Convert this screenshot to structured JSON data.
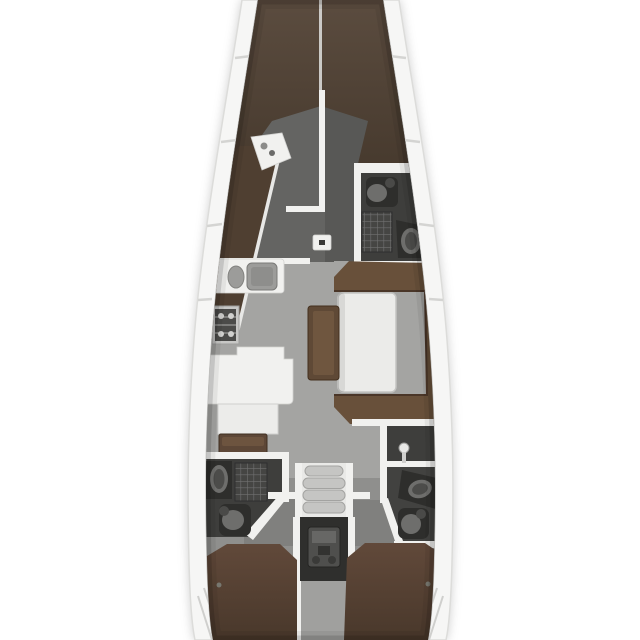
{
  "meta": {
    "title": "Sailing yacht interior floor plan",
    "view": "top-down, bow at top",
    "canvas": {
      "width": 640,
      "height": 640
    }
  },
  "colors": {
    "pageBg": "#ffffff",
    "hullBand": "#f6f6f5",
    "hullOutline": "#dcdcda",
    "deckLine": "#bdbdbb",
    "floorForward": "#646462",
    "floorForwardStbd": "#585856",
    "floorSalon": "#a4a4a2",
    "floorAft": "#8f8f8d",
    "floorCabinEntry": "#80807e",
    "floorCorridor": "#a0a09e",
    "headFloor": "#3e3e3c",
    "berth": "#54463a",
    "berthDark": "#4f3f31",
    "settee": "#68503a",
    "benchSeat": "#5f4936",
    "navSeat": "#5d4737",
    "aftBerth": "#5c4636",
    "white": "#f1f1ef",
    "fixtureLight": "#6e6e6c",
    "fixtureDark": "#2e2e2c",
    "stairTread": "#c5c5c3",
    "engineBay": "#2f2f2d",
    "engine": "#4f4f4d",
    "tableTop": "#ebebe9",
    "sinkSteel": "#9c9c9a"
  },
  "rooms": {
    "forwardCabinPort": {
      "label": "Forward cabin port half",
      "berth": "v-berth"
    },
    "forwardCabinStarboard": {
      "label": "Forward cabin starboard half",
      "berth": "v-berth"
    },
    "forwardHead": {
      "label": "Forward head",
      "fixtures": [
        "toilet",
        "shower-grate",
        "washbasin"
      ]
    },
    "galley": {
      "label": "Galley",
      "fixtures": [
        "double-sink",
        "stove",
        "counter",
        "locker"
      ]
    },
    "salon": {
      "label": "Salon",
      "fixtures": [
        "u-shaped-settee",
        "dining-table",
        "center-bench",
        "mast-post"
      ]
    },
    "navSeat": {
      "label": "Navigation seat"
    },
    "aftHeadPort": {
      "label": "Aft head port",
      "fixtures": [
        "washbasin",
        "shower-grate",
        "toilet"
      ]
    },
    "aftHeadStarboard": {
      "label": "Aft head starboard",
      "fixtures": [
        "shower-head",
        "washbasin",
        "toilet"
      ]
    },
    "companionway": {
      "label": "Companionway stairs",
      "steps": 4
    },
    "engineRoom": {
      "label": "Engine compartment"
    },
    "sternCorridor": {
      "label": "Stern corridor"
    },
    "aftCabinPort": {
      "label": "Aft cabin port",
      "berth": "double"
    },
    "aftCabinStarboard": {
      "label": "Aft cabin starboard",
      "berth": "double"
    }
  }
}
